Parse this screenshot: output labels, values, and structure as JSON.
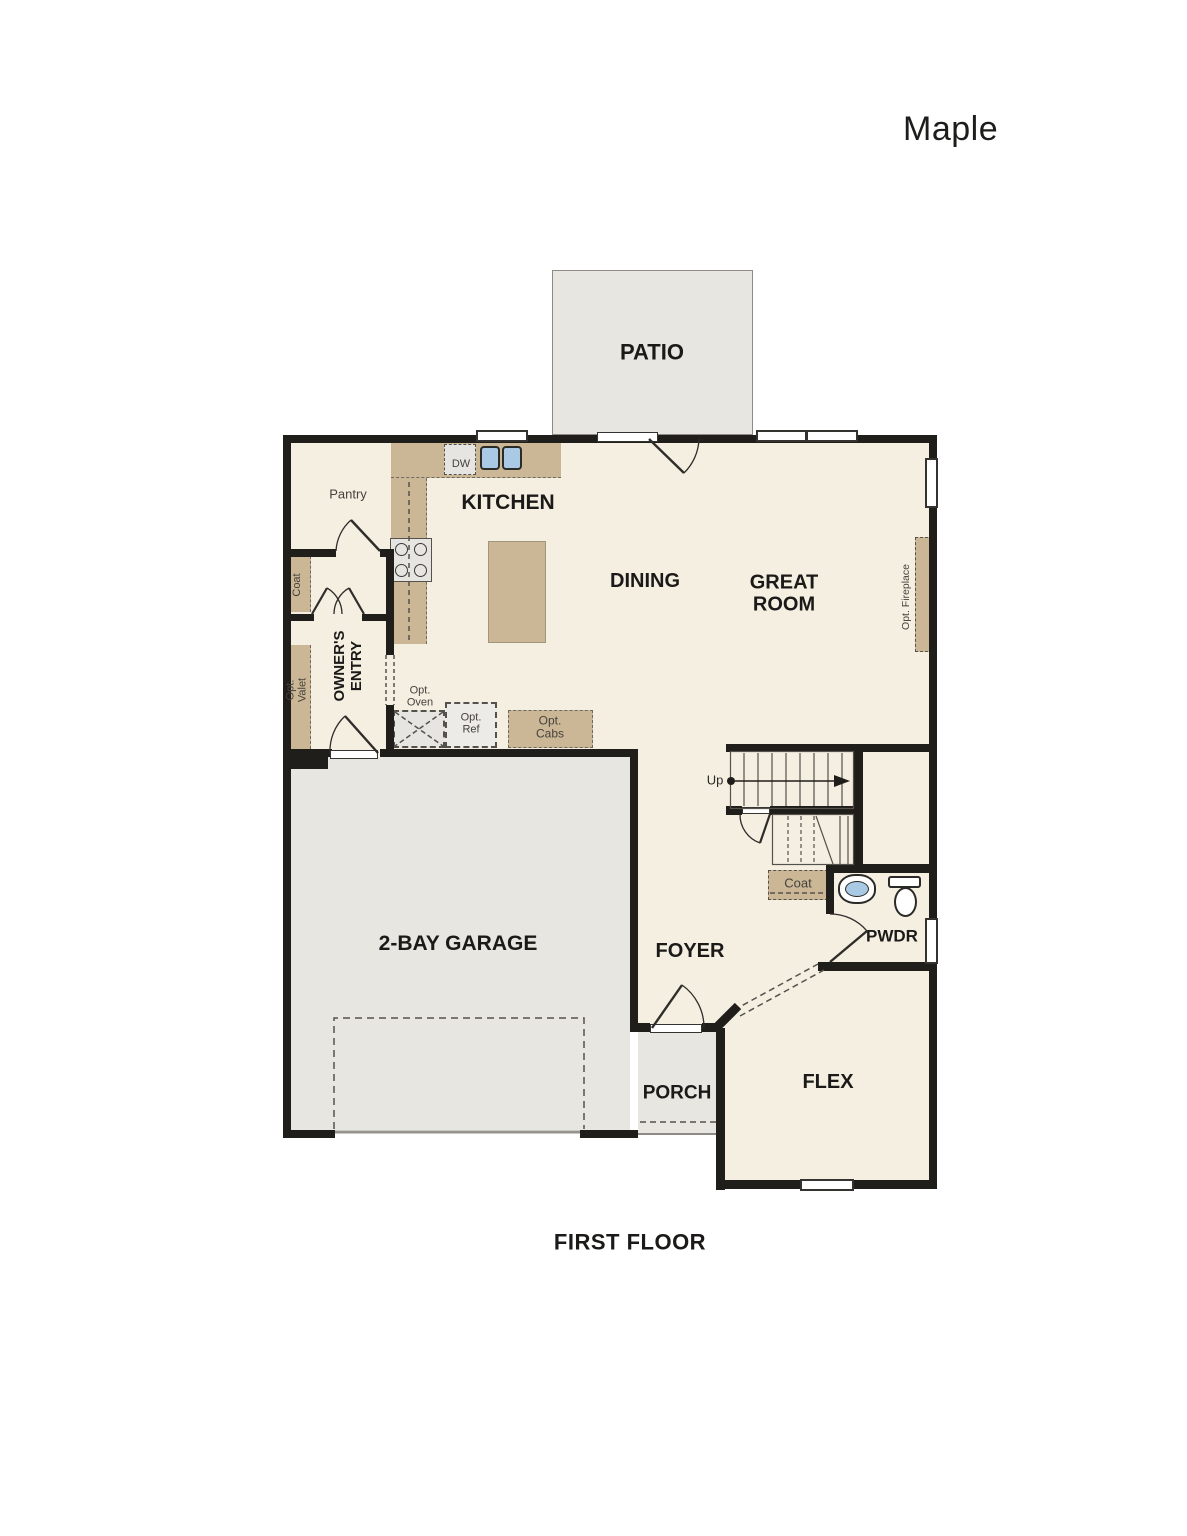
{
  "title": "Maple",
  "caption": "FIRST FLOOR",
  "colors": {
    "floor": "#f4efe1",
    "hardscape": "#e8e6e1",
    "cabinet": "#cbb795",
    "appliance": "#e7e5e1",
    "wall": "#201e1b",
    "sink": "#aac9e4",
    "line": "#55524c",
    "text": "#1b1a18",
    "text-soft": "#45423e"
  },
  "labels": {
    "patio": "PATIO",
    "pantry": "Pantry",
    "kitchen": "KITCHEN",
    "dw": "DW",
    "dining": "DINING",
    "great_room": "GREAT ROOM",
    "owners_entry": "OWNER'S ENTRY",
    "coat_entry": "Coat",
    "opt_valet": "Opt. Valet",
    "opt_oven": "Opt. Oven",
    "opt_ref": "Opt. Ref",
    "opt_cabs": "Opt. Cabs",
    "opt_fireplace": "Opt. Fireplace",
    "up": "Up",
    "coat_stairs": "Coat",
    "pwdr": "PWDR",
    "foyer": "FOYER",
    "garage": "2-BAY GARAGE",
    "porch": "PORCH",
    "flex": "FLEX"
  }
}
